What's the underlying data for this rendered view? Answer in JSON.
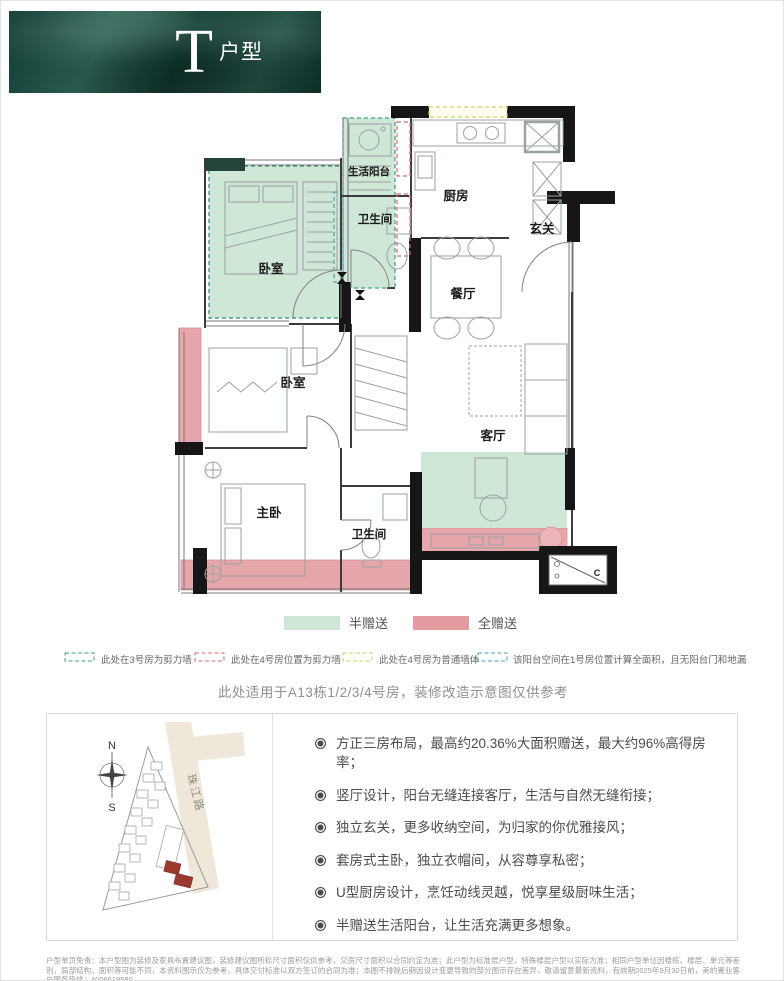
{
  "banner": {
    "letter": "T",
    "label": "户型",
    "bg_color": "#16443a",
    "text_color": "#ffffff"
  },
  "floorplan": {
    "rooms": {
      "balcony": "生活阳台",
      "kitchen": "厨房",
      "entry": "玄关",
      "bath_upper": "卫生间",
      "bedroom_upper": "卧室",
      "dining": "餐厅",
      "bedroom_mid": "卧室",
      "living": "客厅",
      "master": "主卧",
      "bath_lower": "卫生间",
      "ac_mark": "C"
    },
    "colors": {
      "half_gift": "#cfe7d6",
      "full_gift": "#e7a6ab",
      "wall": "#161616"
    }
  },
  "legend_swatches": [
    {
      "label": "半赠送",
      "color": "#cfe7d6"
    },
    {
      "label": "全赠送",
      "color": "#e29b9f"
    }
  ],
  "legend_dashed": [
    {
      "label": "此处在3号房为剪力墙",
      "color": "#3f9f7f"
    },
    {
      "label": "此处在4号房位置为剪力墙",
      "color": "#d96a6a"
    },
    {
      "label": "此处在4号房为普通墙体",
      "color": "#d6ce5e"
    },
    {
      "label": "该阳台空间在1号房位置计算全面积，且无阳台门和地漏",
      "color": "#4a9fae"
    }
  ],
  "note": "此处适用于A13栋1/2/3/4号房，装修改造示意图仅供参考",
  "sitemap": {
    "north": "N",
    "south": "S",
    "road": "珠江路"
  },
  "features": [
    "方正三房布局，最高约20.36%大面积赠送，最大约96%高得房率；",
    "竖厅设计，阳台无缝连接客厅，生活与自然无缝衔接；",
    "独立玄关，更多收纳空间，为归家的你优雅接风；",
    "套房式主卧，独立衣帽间，从容尊享私密；",
    "U型厨房设计，烹饪动线灵越，悦享星级厨味生活；",
    "半赠送生活阳台，让生活充满更多想象。"
  ],
  "disclaimer": "户型单页免责：本户型图为装修及家具布置建议图，装修建议图所标尺寸面积仅供参考，交房尺寸面积以合同约定为准；此户型为标准层户型，特殊楼层户型以实际为准；相同户型单位因楼栋、楼层、单元等差别，局部结构、面积等可能不同，本资料图示仅为参考，具体交付标准以双方签订的合同为准；本图不排除后期因设计变更导致的部分图示存在差异，敬请留意最新资料，有效期2025年9月30日前，美的置业客户服务热线：4006619580"
}
